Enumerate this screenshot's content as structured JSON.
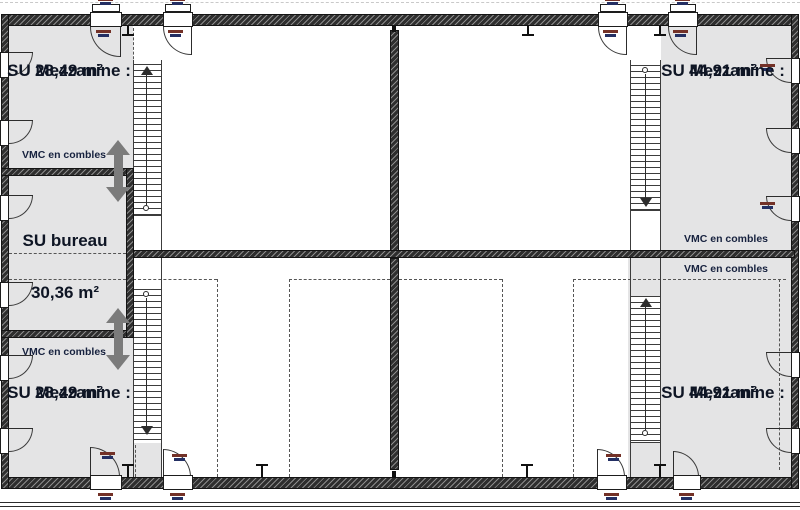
{
  "document": {
    "type": "architectural-floor-plan",
    "level": "mezzanine"
  },
  "rooms": {
    "mezzanine_top_left": {
      "name": "SU Mezzanine :",
      "area": "28,49 m²"
    },
    "mezzanine_top_right": {
      "name": "SU Mezzanine :",
      "area": "44,91 m²"
    },
    "mezzanine_bottom_left": {
      "name": "SU Mezzanine :",
      "area": "28,49 m²"
    },
    "mezzanine_bottom_right": {
      "name": "SU Mezzanine :",
      "area": "44,91 m²"
    },
    "bureau": {
      "name": "SU bureau",
      "area": "30,36 m²"
    }
  },
  "labels": {
    "vmc": "VMC en combles"
  },
  "colors": {
    "room_fill": "#e4e4e5",
    "wall_hatch_dark": "#2e2e2e",
    "wall_hatch_light": "#8c8c8c",
    "line": "#3c3c3c",
    "text": "#0e1524",
    "vmc_arrow": "#7b7b7b",
    "tag_red": "#733127",
    "tag_blue": "#232f63"
  }
}
